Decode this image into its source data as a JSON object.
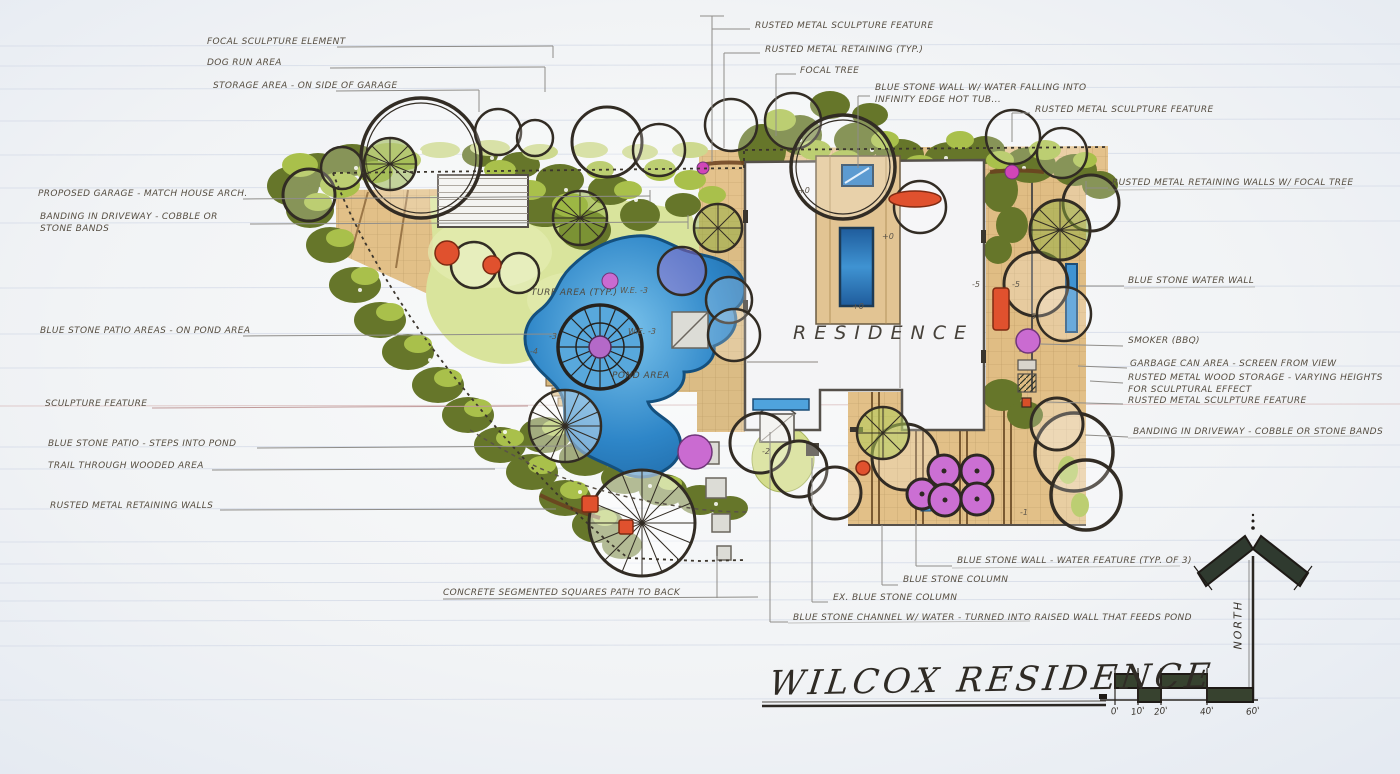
{
  "title": {
    "text": "WILCOX RESIDENCE"
  },
  "annotations": {
    "focal_sculpture_element": "FOCAL SCULPTURE ELEMENT",
    "dog_run_area": "DOG RUN AREA",
    "storage_area": "STORAGE AREA - ON SIDE OF GARAGE",
    "proposed_garage": "PROPOSED GARAGE - MATCH HOUSE ARCH.",
    "banding_driveway_left": "BANDING IN DRIVEWAY - COBBLE OR STONE BANDS",
    "blue_stone_patio_areas": "BLUE STONE PATIO AREAS - ON POND AREA",
    "sculpture_feature": "SCULPTURE FEATURE",
    "blue_stone_patio_steps": "BLUE STONE PATIO - STEPS INTO POND",
    "trail_wooded_area": "TRAIL THROUGH WOODED AREA",
    "rusted_retaining_walls": "RUSTED METAL RETAINING WALLS",
    "rusted_sculpture_top": "RUSTED METAL SCULPTURE FEATURE",
    "rusted_retaining_typ": "RUSTED METAL RETAINING (TYP.)",
    "focal_tree": "FOCAL TREE",
    "blue_stone_wall_hot_tub": "BLUE STONE WALL W/ WATER FALLING INTO INFINITY EDGE HOT TUB...",
    "rusted_sculpture_topright": "RUSTED METAL SCULPTURE FEATURE",
    "rusted_retaining_focal_tree": "RUSTED METAL RETAINING WALLS W/ FOCAL TREE",
    "blue_stone_water_wall": "BLUE STONE WATER WALL",
    "smoker_bbq": "SMOKER (BBQ)",
    "garbage_can_area": "GARBAGE CAN AREA - SCREEN FROM VIEW",
    "rusted_wood_storage": "RUSTED METAL WOOD STORAGE - VARYING HEIGHTS FOR SCULPTURAL EFFECT",
    "rusted_sculpture_right": "RUSTED METAL SCULPTURE FEATURE",
    "banding_driveway_right": "BANDING IN DRIVEWAY - COBBLE OR STONE BANDS",
    "blue_stone_wall_water_feature": "BLUE STONE WALL - WATER FEATURE (TYP. OF 3)",
    "blue_stone_column": "BLUE STONE COLUMN",
    "ex_blue_stone_column": "EX. BLUE STONE COLUMN",
    "blue_stone_channel": "BLUE STONE CHANNEL W/ WATER - TURNED INTO RAISED WALL THAT FEEDS POND",
    "concrete_path": "CONCRETE SEGMENTED SQUARES PATH TO BACK"
  },
  "plan_labels": {
    "residence": "RESIDENCE",
    "turf_area": "TURF AREA (TYP.)",
    "pond_area": "POND AREA",
    "water_elev_1": "W.E. -3",
    "water_elev_2": "W.E. -3"
  },
  "elevation_markers": {
    "m1": "+0",
    "m2": "+0",
    "m3": "+0",
    "m4": "-5",
    "m5": "-5",
    "m6": "-3",
    "m7": "-4",
    "m8": "-2",
    "m9": "-5",
    "m10": "-1"
  },
  "north": {
    "label": "NORTH"
  },
  "scale": {
    "t0": "0'",
    "t1": "10'",
    "t2": "20'",
    "t3": "40'",
    "t4": "60'"
  },
  "palette": {
    "paper": "#eef1f6",
    "ink": "#564e42",
    "foliage_dark": "#66762a",
    "foliage_light": "#a9c04b",
    "turf": "#d9e49c",
    "water": "#2e86c8",
    "paving_tan": "#e0bd84",
    "accent_red": "#e0512e",
    "accent_purple": "#ca6bd1",
    "stone_grey": "#dcdcd6"
  }
}
